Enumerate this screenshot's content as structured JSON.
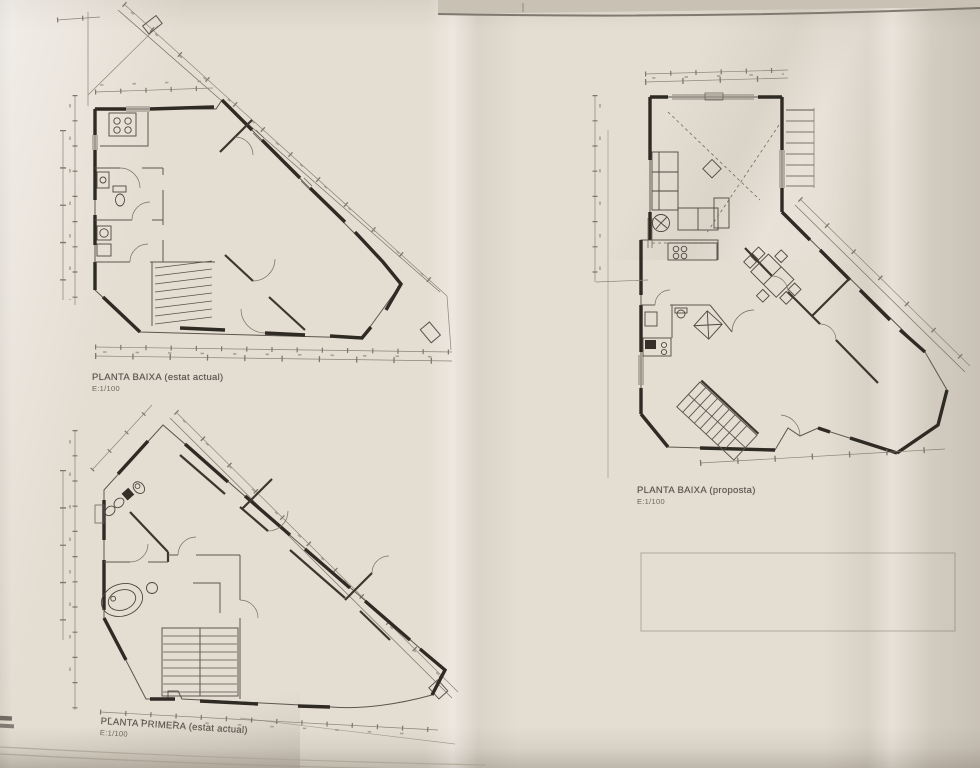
{
  "sheet": {
    "description": "photographed architectural drawing sheet, folded paper",
    "paper_color": "#e4ddd2",
    "ink_color": "#55504a",
    "wall_color": "#2e2a24",
    "dim_color": "#8a8478"
  },
  "plans": [
    {
      "id": "planta-baixa-estat-actual",
      "title": "PLANTA BAIXA (estat actual)",
      "scale": "E:1/100"
    },
    {
      "id": "planta-baixa-proposta",
      "title": "PLANTA BAIXA (proposta)",
      "scale": "E:1/100"
    },
    {
      "id": "planta-primera-estat-actual",
      "title": "PLANTA PRIMERA (estat actual)",
      "scale": "E:1/100"
    }
  ]
}
